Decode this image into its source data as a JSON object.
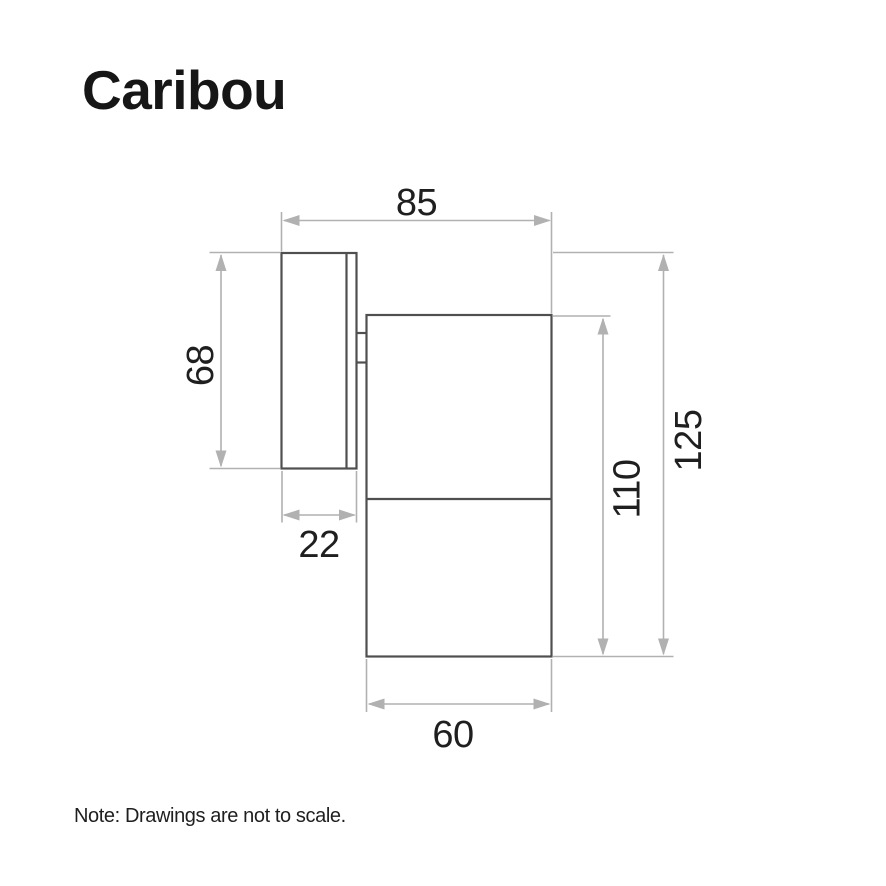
{
  "brand": {
    "logo_text": "Caribou"
  },
  "footer": {
    "note_text": "Note: Drawings are not to scale."
  },
  "colors": {
    "background": "#ffffff",
    "product_outline": "#4f4f4f",
    "dimension_line": "#b1b1b1",
    "dimension_text": "#1f1f1f",
    "logo_text": "#161616",
    "note_text": "#1f1f1f"
  },
  "diagram": {
    "dimensions": [
      {
        "name": "overall-depth",
        "value": "85"
      },
      {
        "name": "backplate-height",
        "value": "68"
      },
      {
        "name": "backplate-depth",
        "value": "22"
      },
      {
        "name": "body-height",
        "value": "110"
      },
      {
        "name": "overall-height",
        "value": "125"
      },
      {
        "name": "body-width",
        "value": "60"
      }
    ]
  }
}
